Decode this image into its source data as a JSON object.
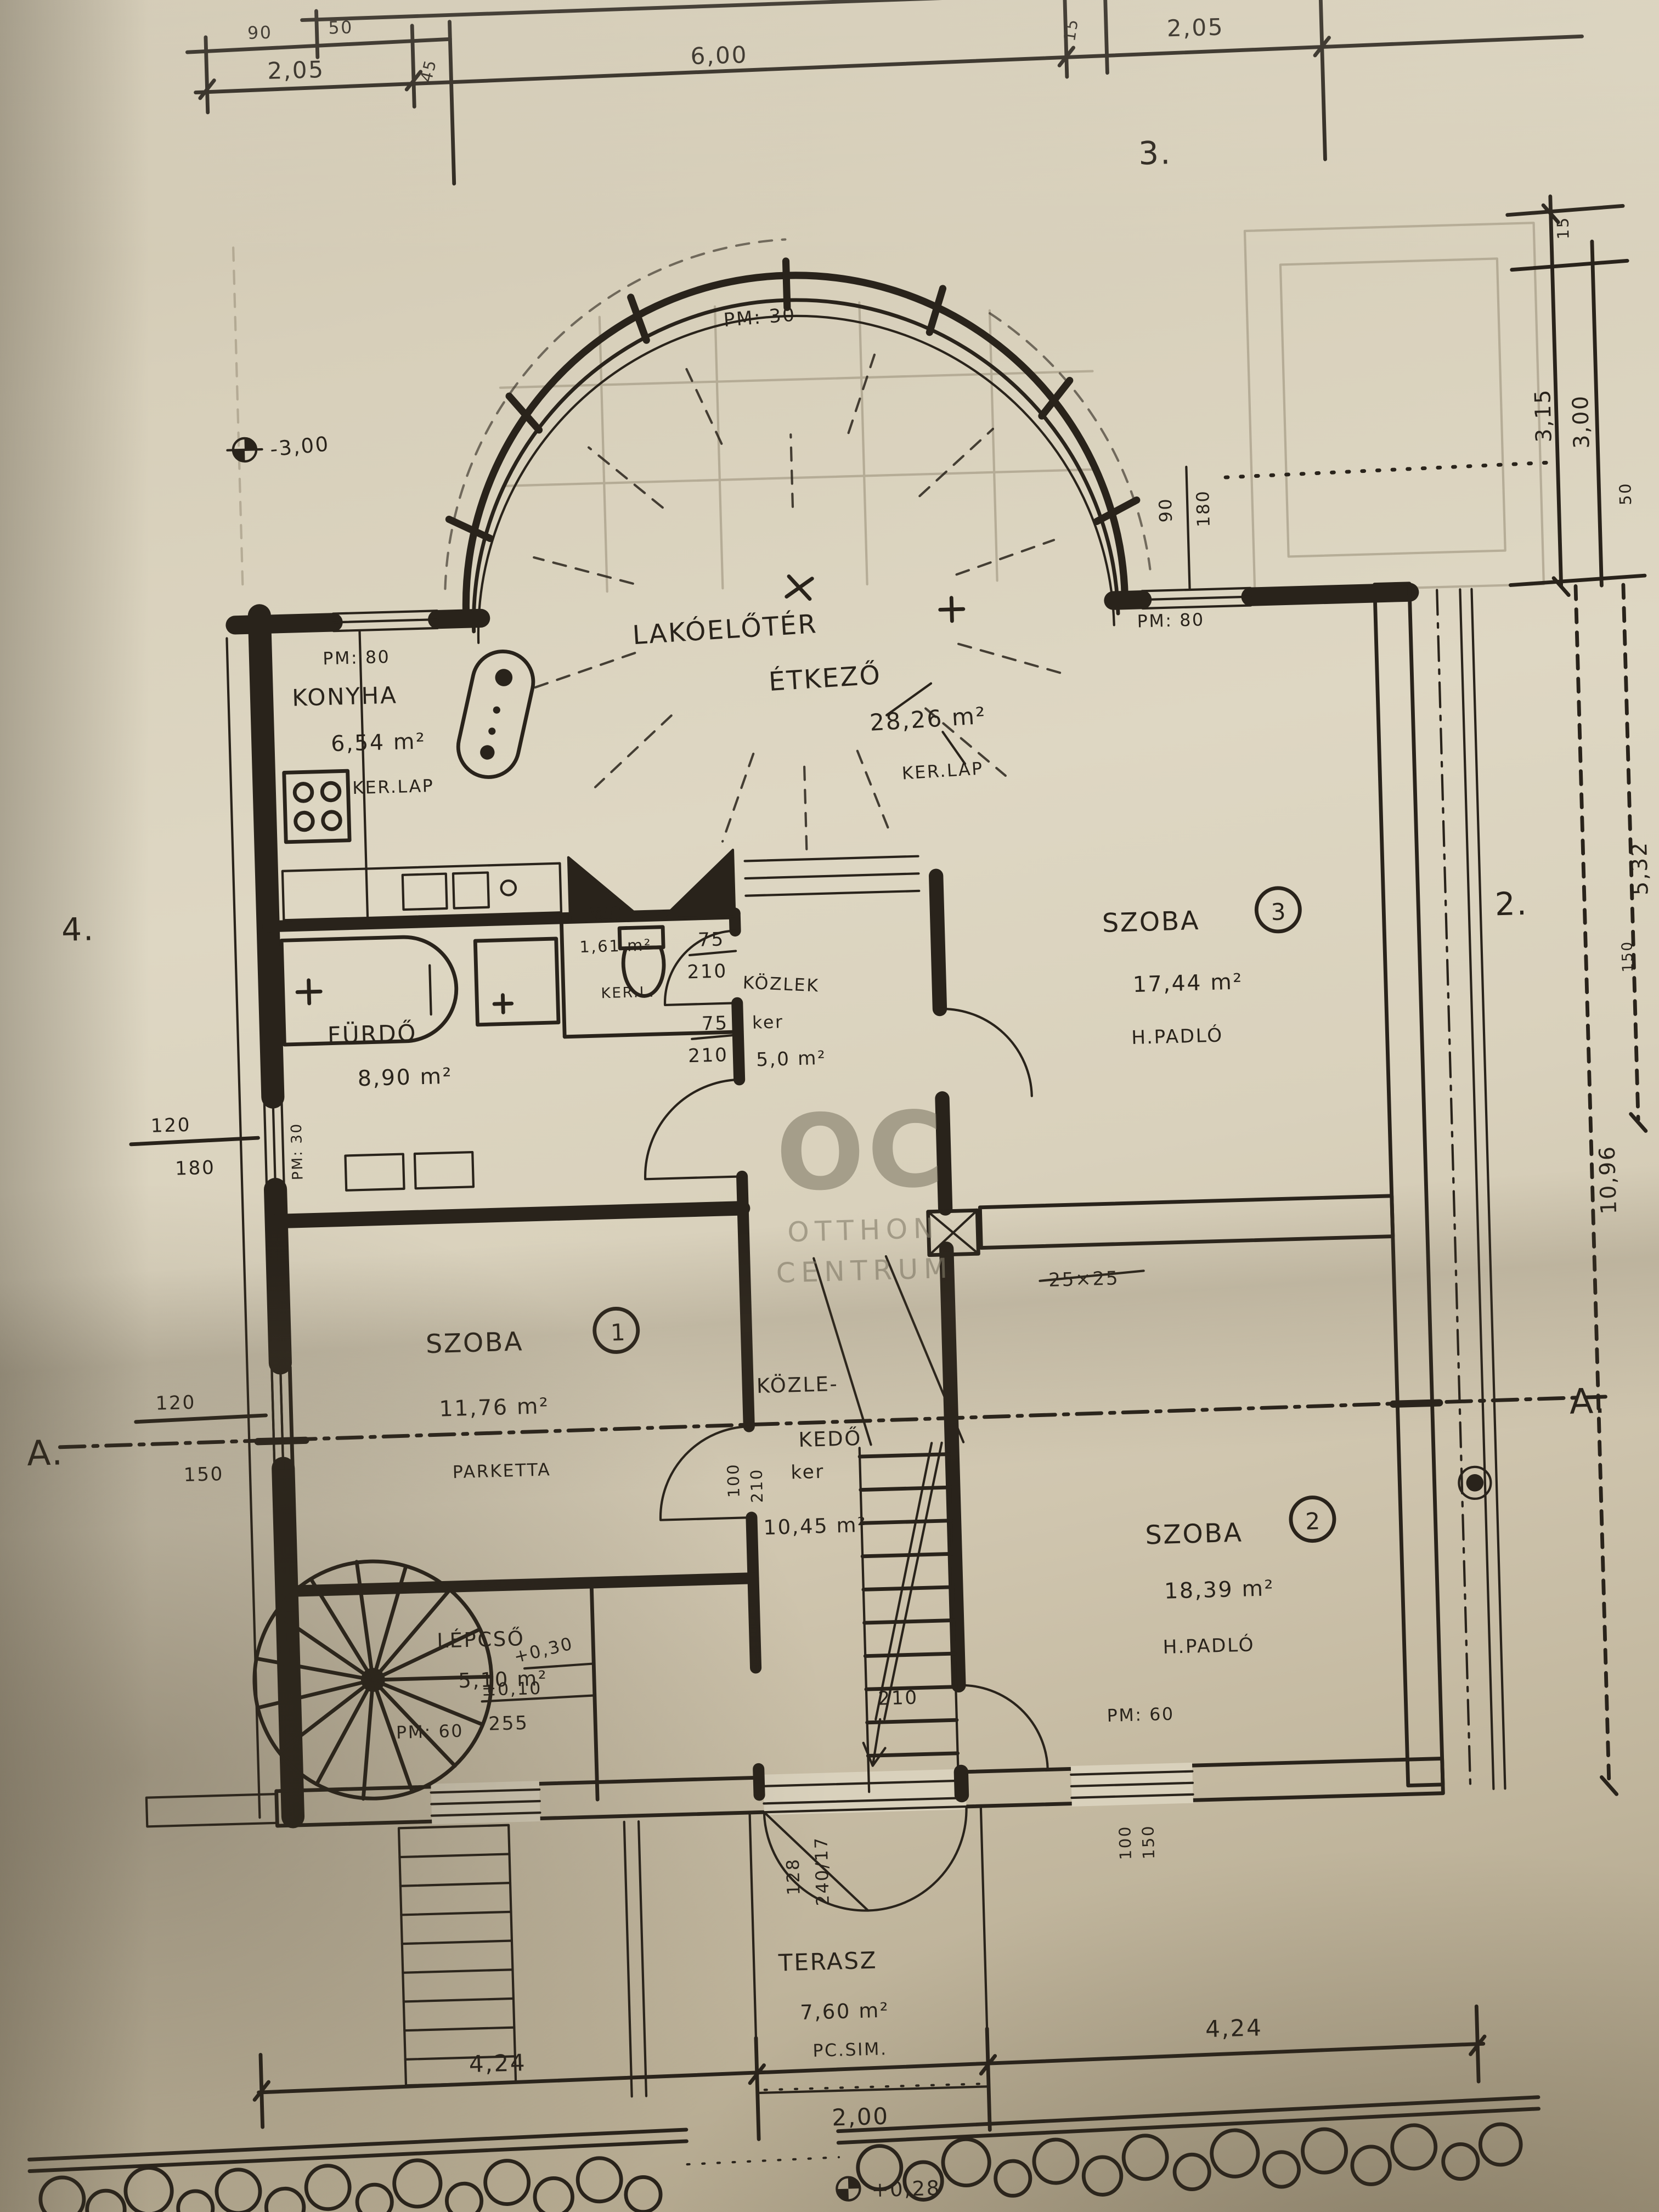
{
  "watermark": {
    "mono": "OC",
    "l1": "OTTHON",
    "l2": "CENTRUM"
  },
  "markers": {
    "sheet3": "3.",
    "sheet4": "4.",
    "sheet2": "2.",
    "a_left": "A.",
    "a_right": "A."
  },
  "bay": {
    "pm": "PM: 30"
  },
  "chimney": "25×25",
  "rooms": {
    "living": {
      "line1": "LAKÓELŐTÉR",
      "line2": "ÉTKEZŐ",
      "area": "28,26 m²",
      "floor": "KER.LAP"
    },
    "konyha": {
      "name": "KONYHA",
      "area": "6,54 m²",
      "floor": "KER.LAP",
      "pm": "PM: 80"
    },
    "szoba3": {
      "name": "SZOBA",
      "num": "3",
      "area": "17,44 m²",
      "floor": "H.PADLÓ",
      "pm": "PM: 80",
      "win_w": "90",
      "win_h": "180"
    },
    "wc": {
      "name": "WC",
      "area": "1,61 m²",
      "floor": "KER.L.",
      "door_w": "75",
      "door_h": "210"
    },
    "kozlek_upper": {
      "name": "KÖZLEK",
      "floor": "ker",
      "area": "5,0 m²",
      "door_w": "75",
      "door_h": "210"
    },
    "furdo": {
      "name": "FÜRDŐ",
      "area": "8,90 m²",
      "pm": "PM: 30"
    },
    "szoba1": {
      "name": "SZOBA",
      "num": "1",
      "area": "11,76 m²",
      "floor": "PARKETTA"
    },
    "kozlekedo": {
      "line1": "KÖZLE-",
      "line2": "KEDŐ",
      "floor": "ker",
      "area": "10,45 m²",
      "door_w": "100",
      "door_h": "210"
    },
    "szoba2": {
      "name": "SZOBA",
      "num": "2",
      "area": "18,39 m²",
      "floor": "H.PADLÓ",
      "pm": "PM: 60",
      "door": "210",
      "win_w": "100",
      "win_h": "150"
    },
    "lepcso": {
      "name": "LÉPCSŐ",
      "area": "5,10 m²",
      "pm": "PM: 60",
      "lv1": "+0,30",
      "lv2": "±0,10",
      "lv3": "255"
    },
    "terasz": {
      "name": "TERASZ",
      "area": "7,60 m²",
      "floor": "PC.SIM.",
      "d1": "128",
      "d2": "240/17",
      "level": "+0,28"
    }
  },
  "dims": {
    "level_entry": "-3,00",
    "top": {
      "s1": "90",
      "s2": "50",
      "a": "2,05",
      "b": "45",
      "c": "6,00",
      "d": "15",
      "e": "2,05"
    },
    "right": {
      "s1": "15",
      "a": "3,15",
      "b": "3,00",
      "s2": "50",
      "c": "5,32",
      "s3": "150",
      "total": "10,96"
    },
    "left": {
      "w1": "120",
      "h1": "180",
      "w2": "120",
      "h2": "150"
    },
    "bottom": {
      "a": "4,24",
      "b": "4,24",
      "mid": "2,00"
    }
  }
}
